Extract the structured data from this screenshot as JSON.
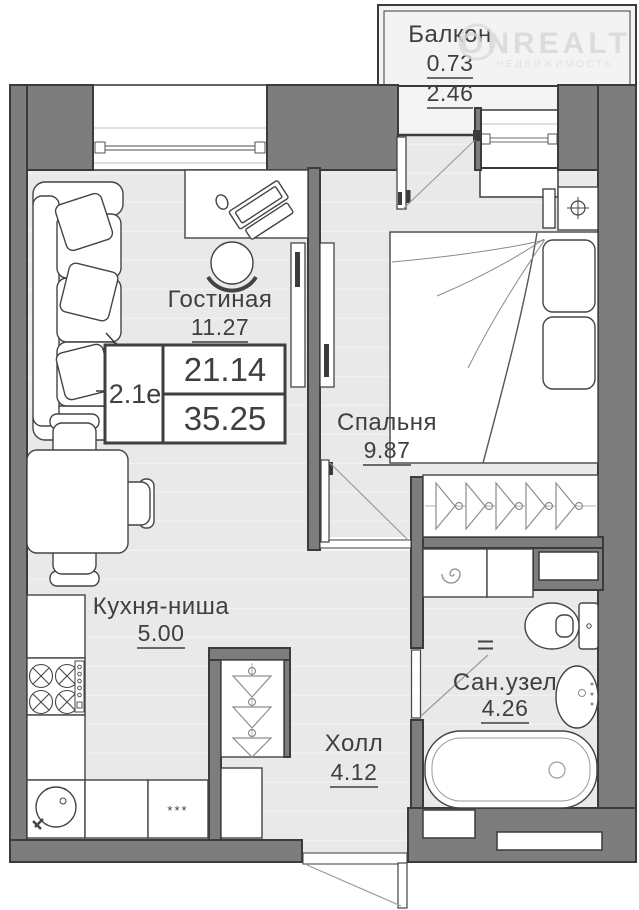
{
  "plan": {
    "unit": {
      "type_label": "2.1е",
      "living_area": "21.14",
      "total_area": "35.25"
    },
    "rooms": {
      "balcony": {
        "name": "Балкон",
        "reduced_area": "0.73",
        "area": "2.46"
      },
      "living_room": {
        "name": "Гостиная",
        "area": "11.27"
      },
      "bedroom": {
        "name": "Спальня",
        "area": "9.87"
      },
      "kitchen_niche": {
        "name": "Кухня-ниша",
        "area": "5.00"
      },
      "hall": {
        "name": "Холл",
        "area": "4.12"
      },
      "bathroom": {
        "name": "Сан.узел",
        "area": "4.26"
      }
    },
    "marks": {
      "kitchen_asterisks": "***"
    },
    "watermark": {
      "brand": "ONREALT",
      "tagline": "НЕДВИЖИМОСТЬ"
    },
    "colors": {
      "wall": "#7d7d7d",
      "wall_outline": "#3b3b3b",
      "floor": "#e9e9e9",
      "balcony_floor": "#f3f3f3",
      "text": "#3f3f3f",
      "watermark": "#d7d7d7"
    }
  }
}
